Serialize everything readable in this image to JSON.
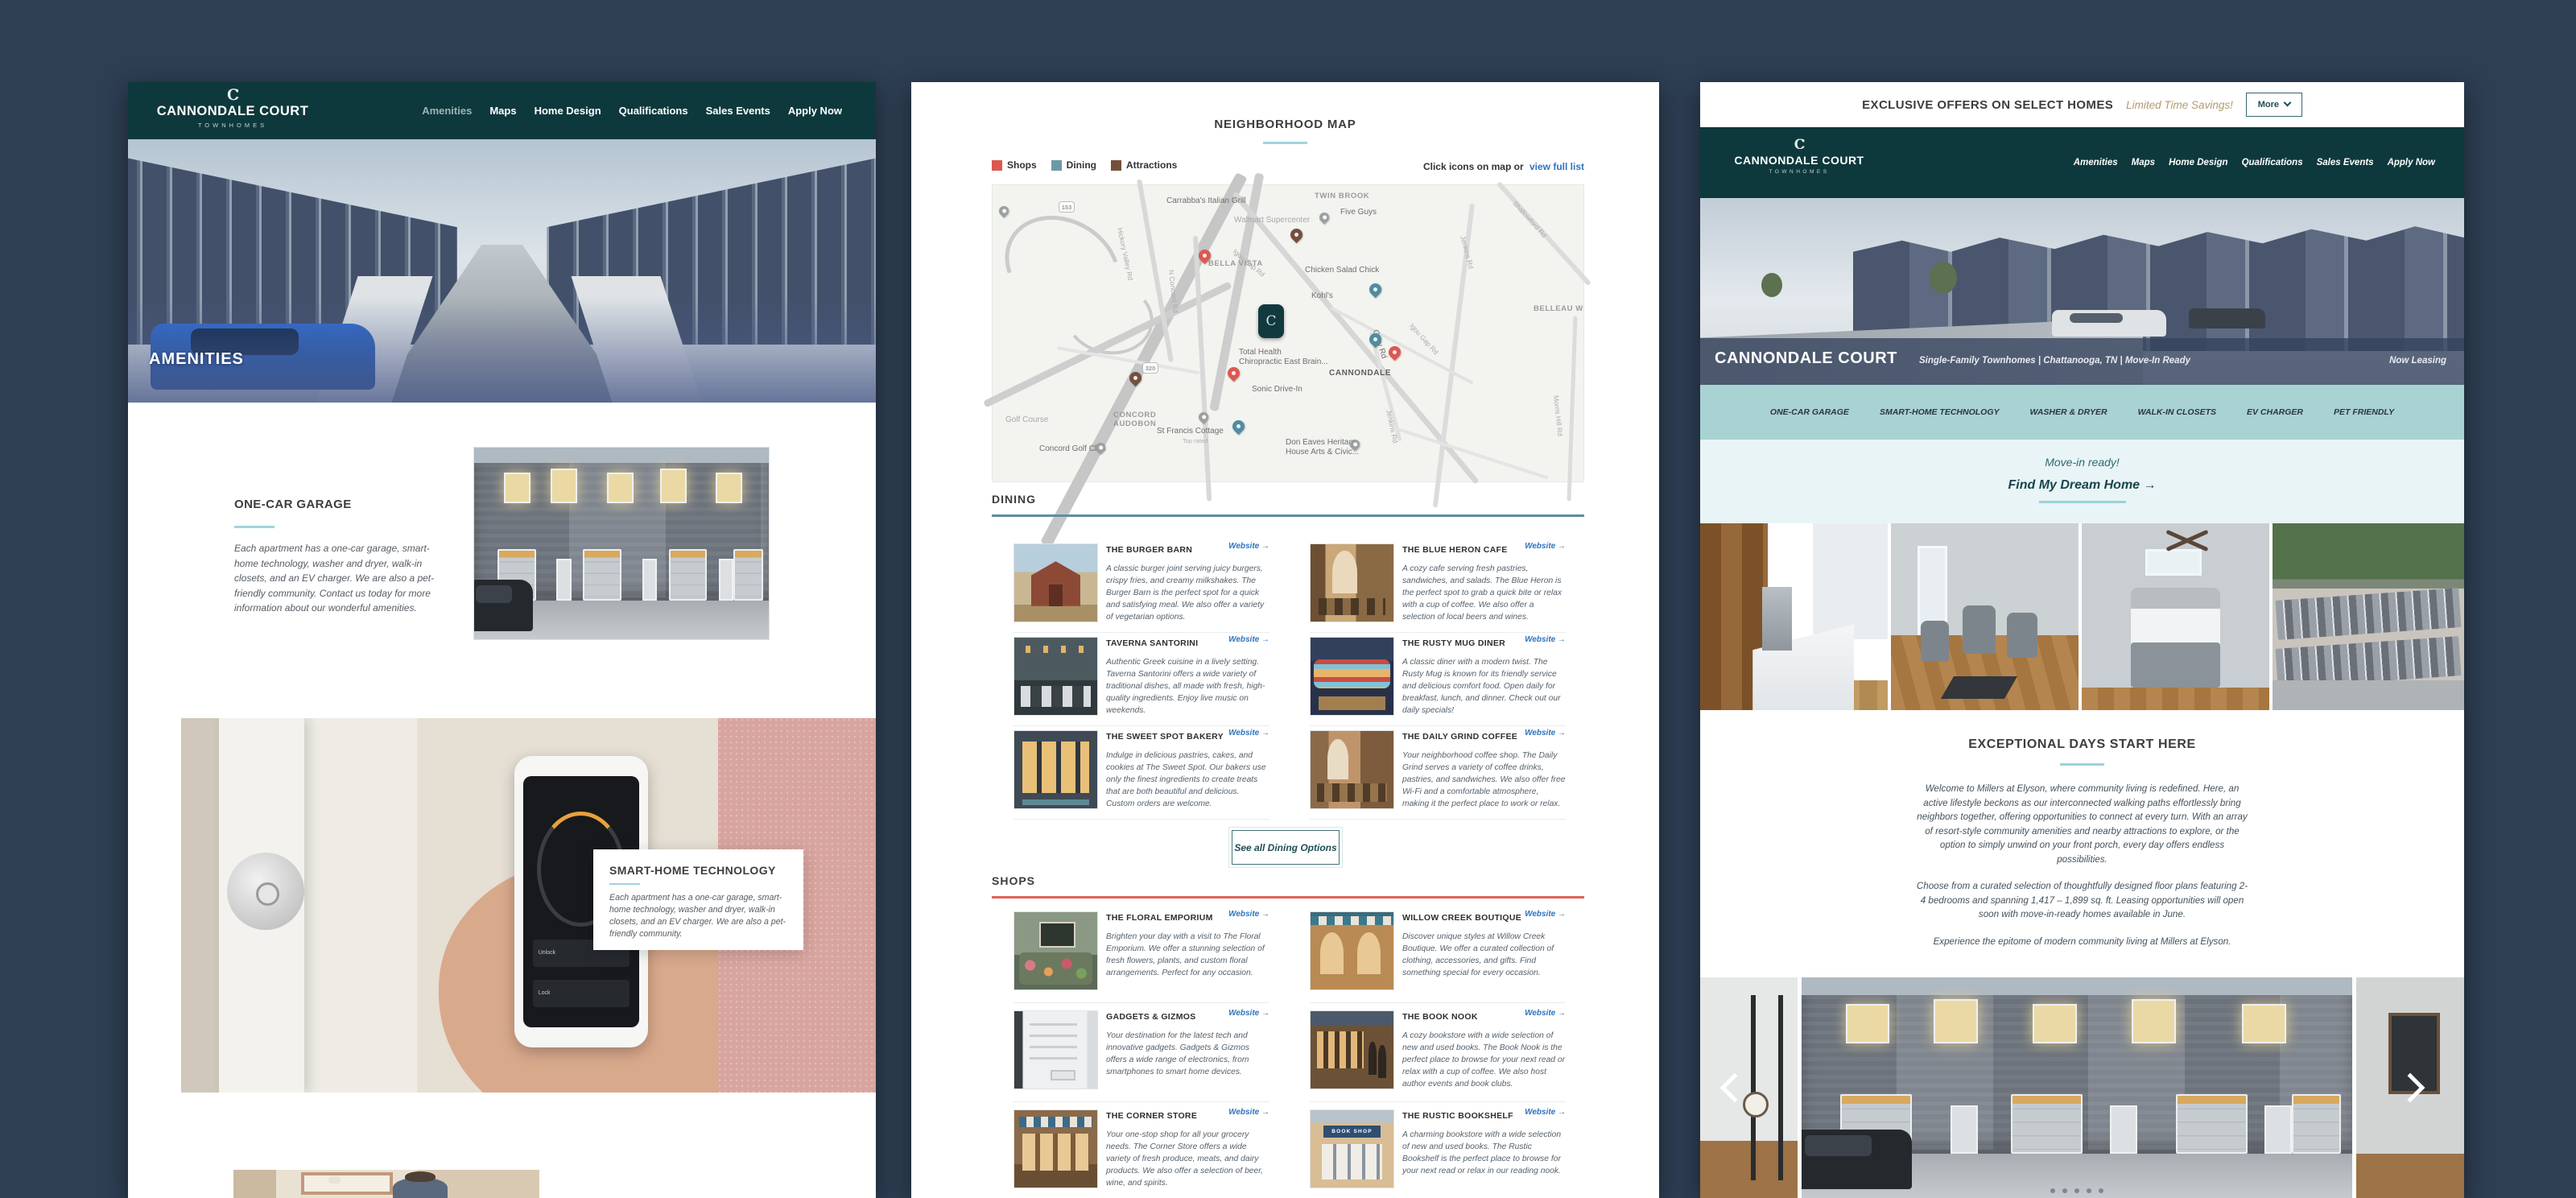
{
  "brand": {
    "monogram": "C",
    "name": "CANNONDALE COURT",
    "tagline": "TOWNHOMES"
  },
  "nav": [
    "Amenities",
    "Maps",
    "Home Design",
    "Qualifications",
    "Sales Events",
    "Apply Now"
  ],
  "left": {
    "hero_label": "AMENITIES",
    "garage_title": "ONE-CAR GARAGE",
    "garage_body": "Each apartment has a one-car garage, smart-home technology, washer and dryer, walk-in closets, and an EV charger. We are also a pet-friendly community. Contact us today for more information about our wonderful amenities.",
    "smart_title": "SMART-HOME TECHNOLOGY",
    "smart_body": "Each apartment has a one-car garage, smart-home technology, washer and dryer, walk-in closets, and an EV charger. We are also a pet-friendly community.",
    "phone_unlock": "Unlock",
    "phone_lock": "Lock"
  },
  "middle": {
    "title": "NEIGHBORHOOD MAP",
    "legend_shops": "Shops",
    "legend_dining": "Dining",
    "legend_attractions": "Attractions",
    "legend_colors": {
      "shops": "#dd5850",
      "dining": "#6b9aa6",
      "attractions": "#74503c"
    },
    "map_hint": "Click icons on map or",
    "map_link": "view full list",
    "map_labels": [
      "Carrabba's Italian Grill",
      "TWIN BROOK",
      "Five Guys",
      "Walmart Supercenter",
      "153",
      "Hickory Valley Rd",
      "BELLA VISTA",
      "Igou Gap Rd",
      "N Concord Rd",
      "Chicken Salad Chick",
      "Jenkins Rd",
      "Shallowford Rd",
      "Kohl's",
      "BELLEAU W",
      "Igou Gap Rd",
      "Total Health",
      "Chiropractic East Brain...",
      "Gray Rd",
      "CANNONDALE",
      "320",
      "Sonic Drive-In",
      "CONCORD",
      "AUDOBON",
      "St Francis Cottage",
      "Top rated",
      "Don Eaves Heritage",
      "House Arts & Civic...",
      "Golf Course",
      "Concord Golf Club",
      "Jenkins Rd",
      "Morris Hill Rd"
    ],
    "website_label": "Website →",
    "dining_title": "DINING",
    "dining": [
      {
        "name": "THE BURGER BARN",
        "desc": "A classic burger joint serving juicy burgers, crispy fries, and creamy milkshakes. The Burger Barn is the perfect spot for a quick and satisfying meal. We also offer a variety of vegetarian options."
      },
      {
        "name": "THE BLUE HERON CAFE",
        "desc": "A cozy cafe serving fresh pastries, sandwiches, and salads. The Blue Heron is the perfect spot to grab a quick bite or relax with a cup of coffee. We also offer a selection of local beers and wines."
      },
      {
        "name": "TAVERNA SANTORINI",
        "desc": "Authentic Greek cuisine in a lively setting. Taverna Santorini offers a wide variety of traditional dishes, all made with fresh, high-quality ingredients. Enjoy live music on weekends."
      },
      {
        "name": "THE RUSTY MUG DINER",
        "desc": "A classic diner with a modern twist. The Rusty Mug is known for its friendly service and delicious comfort food. Open daily for breakfast, lunch, and dinner. Check out our daily specials!"
      },
      {
        "name": "THE SWEET SPOT BAKERY",
        "desc": "Indulge in delicious pastries, cakes, and cookies at The Sweet Spot. Our bakers use only the finest ingredients to create treats that are both beautiful and delicious. Custom orders are welcome."
      },
      {
        "name": "THE DAILY GRIND COFFEE",
        "desc": "Your neighborhood coffee shop. The Daily Grind serves a variety of coffee drinks, pastries, and sandwiches. We also offer free Wi-Fi and a comfortable atmosphere, making it the perfect place to work or relax."
      }
    ],
    "see_all": "See all Dining Options",
    "shops_title": "SHOPS",
    "shops": [
      {
        "name": "THE FLORAL EMPORIUM",
        "desc": "Brighten your day with a visit to The Floral Emporium. We offer a stunning selection of fresh flowers, plants, and custom floral arrangements. Perfect for any occasion."
      },
      {
        "name": "WILLOW CREEK BOUTIQUE",
        "desc": "Discover unique styles at Willow Creek Boutique. We offer a curated collection of clothing, accessories, and gifts. Find something special for every occasion."
      },
      {
        "name": "GADGETS & GIZMOS",
        "desc": "Your destination for the latest tech and innovative gadgets. Gadgets & Gizmos offers a wide range of electronics, from smartphones to smart home devices."
      },
      {
        "name": "THE BOOK NOOK",
        "desc": "A cozy bookstore with a wide selection of new and used books. The Book Nook is the perfect place to browse for your next read or relax with a cup of coffee. We also host author events and book clubs."
      },
      {
        "name": "THE CORNER STORE",
        "desc": "Your one-stop shop for all your grocery needs. The Corner Store offers a wide variety of fresh produce, meats, and dairy products. We also offer a selection of beer, wine, and spirits."
      },
      {
        "name": "THE RUSTIC BOOKSHELF",
        "desc": "A charming bookstore with a wide selection of new and used books. The Rustic Bookshelf is the perfect place to browse for your next read or relax in our reading nook."
      }
    ],
    "book_sign": "BOOK SHOP"
  },
  "right": {
    "banner_title": "EXCLUSIVE OFFERS ON SELECT HOMES",
    "banner_sub": "Limited Time Savings!",
    "banner_more": "More",
    "hero_title": "CANNONDALE COURT",
    "hero_tagline": "Single-Family Townhomes | Chattanooga, TN | Move-In Ready",
    "hero_leasing": "Now Leasing",
    "features": [
      "ONE-CAR GARAGE",
      "SMART-HOME TECHNOLOGY",
      "WASHER & DRYER",
      "WALK-IN CLOSETS",
      "EV CHARGER",
      "PET FRIENDLY"
    ],
    "cta_ready": "Move-in ready!",
    "cta_find": "Find My Dream Home →",
    "about_title": "EXCEPTIONAL DAYS START HERE",
    "about_p1": "Welcome to Millers at Elyson, where community living is redefined. Here, an active lifestyle beckons as our interconnected walking paths effortlessly bring neighbors together, offering opportunities to connect at every turn. With an array of resort-style community amenities and nearby attractions to explore, or the option to simply unwind on your front porch, every day offers endless possibilities.",
    "about_p2": "Choose from a curated selection of thoughtfully designed floor plans featuring 2-4 bedrooms and spanning 1,417 – 1,899 sq. ft. Leasing opportunities will open soon with move-in-ready homes available in June.",
    "about_p3": "Experience the epitome of modern community living at Millers at Elyson."
  }
}
